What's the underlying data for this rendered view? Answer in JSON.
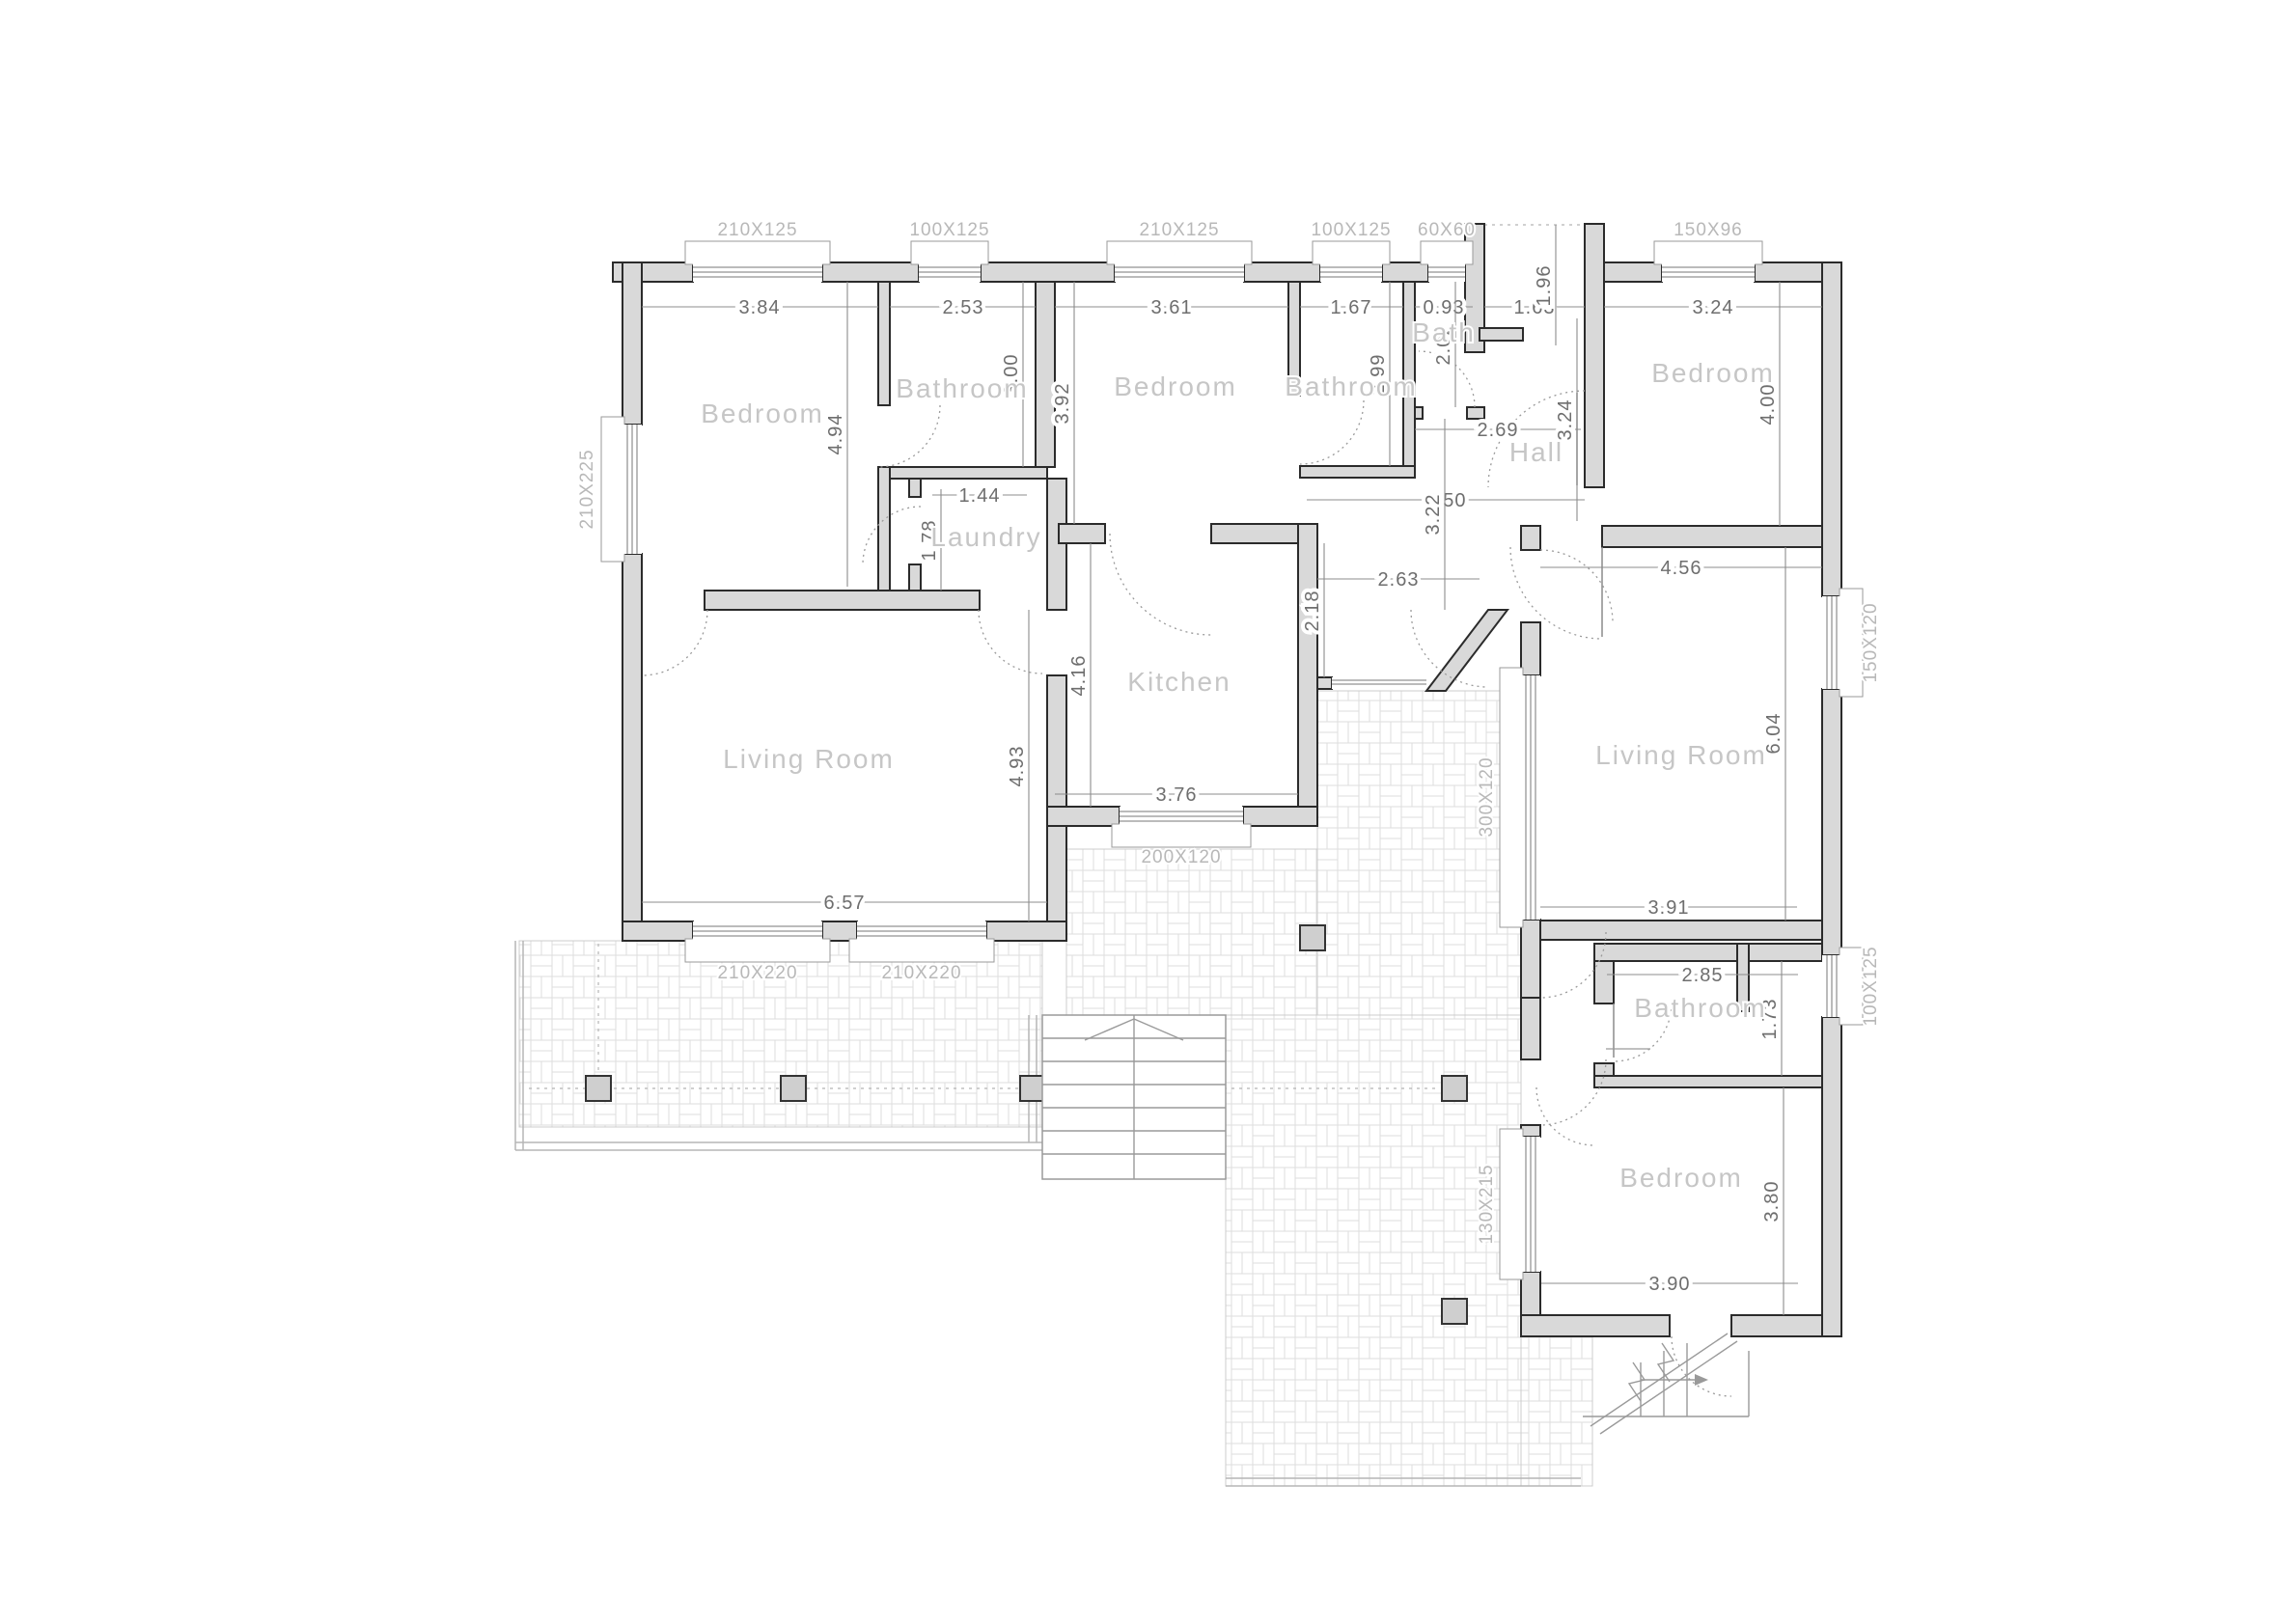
{
  "rooms": {
    "bedroom1": "Bedroom",
    "bathroom1": "Bathroom",
    "laundry": "Laundry",
    "bedroom2": "Bedroom",
    "bathroom2": "Bathroom",
    "bath": "Bath",
    "hall": "Hall",
    "bedroom3": "Bedroom",
    "kitchen": "Kitchen",
    "living1": "Living Room",
    "living2": "Living Room",
    "bathroom3": "Bathroom",
    "bedroom4": "Bedroom"
  },
  "dims": {
    "bd1_w": "3.84",
    "bd1_h": "4.94",
    "ba1_w": "2.53",
    "ba1_h": "3.00",
    "bd2_w": "3.61",
    "bd2_h": "3.92",
    "ba2_w": "1.67",
    "ba2_h": "2.99",
    "bath_w": "0.93",
    "bath_h": "2.02",
    "entry_w": "1.63",
    "entry_d": "1.96",
    "bd3_w": "3.24",
    "bd3_h": "4.00",
    "laundry_w": "1.44",
    "laundry_h": "1.78",
    "hall_b": "2.69",
    "hall_w": "4.50",
    "hall_h": "3.22",
    "hall_e": "3.24",
    "kitchen_cw": "2.63",
    "kitchen_cd": "2.18",
    "kitchen_h": "4.16",
    "kitchen_w": "3.76",
    "lr1_w": "6.57",
    "lr1_h": "4.93",
    "lr2_top": "4.56",
    "lr2_h": "6.04",
    "lr2_b": "3.91",
    "ba3_w": "2.85",
    "ba3_h": "1.73",
    "bd4_h": "3.80",
    "bd4_w": "3.90"
  },
  "windows": {
    "w1": "210X125",
    "w2": "100X125",
    "w3": "210X125",
    "w4": "100X125",
    "w5": "60X60",
    "w6": "150X96",
    "w7": "210X225",
    "w8": "200X120",
    "w9": "150X120",
    "w10": "300X120",
    "w11": "130X215",
    "w12": "100X125",
    "w13": "210X220",
    "w14": "210X220"
  }
}
